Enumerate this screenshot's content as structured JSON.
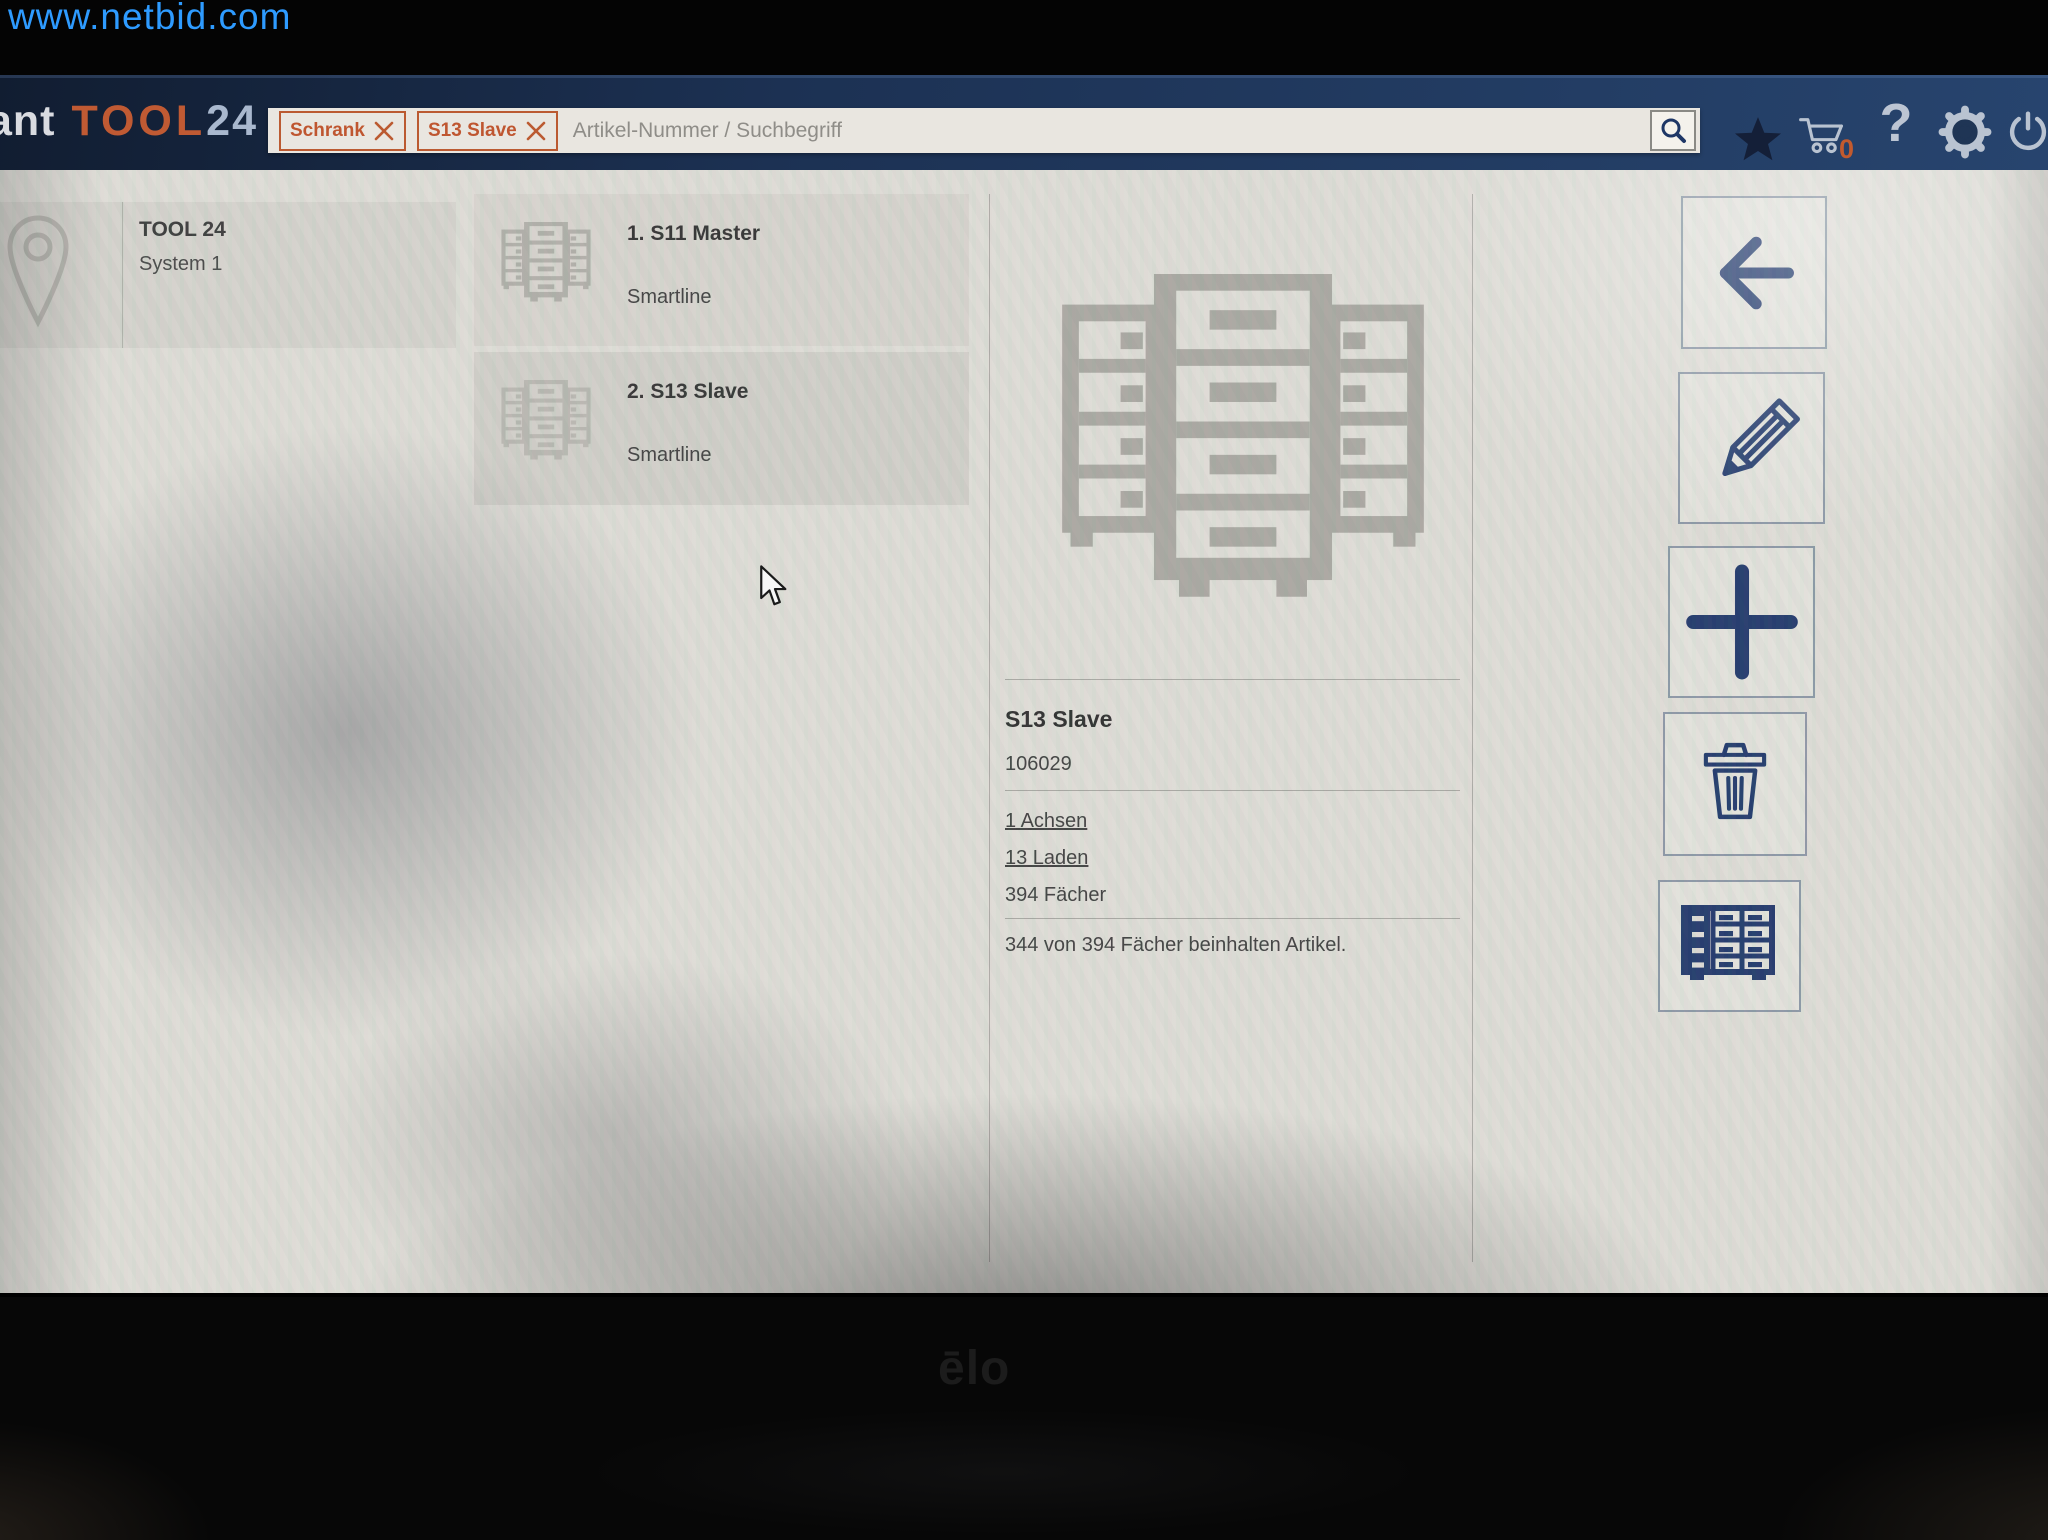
{
  "watermark": {
    "url_text": "www.netbid.com"
  },
  "header": {
    "brand": {
      "prefix": "ant",
      "tool": "TOOL",
      "suffix": "24"
    },
    "search": {
      "filter_chips": [
        {
          "label": "Schrank"
        },
        {
          "label": "S13 Slave"
        }
      ],
      "placeholder": "Artikel-Nummer / Suchbegriff"
    },
    "cart_badge": "0",
    "icons": [
      "search-icon",
      "star-icon",
      "cart-icon",
      "help-icon",
      "settings-gear-icon",
      "power-icon"
    ],
    "help_glyph": "?"
  },
  "location_panel": {
    "icon": "location-pin-icon",
    "title": "TOOL 24",
    "subtitle": "System 1"
  },
  "cabinet_list": {
    "items": [
      {
        "icon": "cabinet-icon",
        "title": "1. S11 Master",
        "subtitle": "Smartline",
        "selected": false
      },
      {
        "icon": "cabinet-icon",
        "title": "2. S13 Slave",
        "subtitle": "Smartline",
        "selected": true
      }
    ]
  },
  "detail": {
    "illustration": "cabinet-illustration",
    "title": "S13 Slave",
    "number": "106029",
    "axes_link": "1 Achsen",
    "drawers_link": "13 Laden",
    "compartments": "394 Fächer",
    "summary": "344 von 394 Fächer beinhalten Artikel."
  },
  "action_panel": {
    "buttons": [
      {
        "name": "back",
        "icon": "arrow-left-icon"
      },
      {
        "name": "edit",
        "icon": "pencil-icon"
      },
      {
        "name": "add",
        "icon": "plus-icon"
      },
      {
        "name": "delete",
        "icon": "trash-icon"
      },
      {
        "name": "cabinet-view",
        "icon": "drawer-cabinet-icon"
      }
    ]
  },
  "monitor": {
    "brand": "ēlo"
  },
  "colors": {
    "accent_orange": "#c0562f",
    "icon_navy": "#21386b",
    "header_navy": "#1d3254",
    "content_bg": "#dcdad4",
    "illustration_gray": "#a9a7a1",
    "watermark_blue": "#2e9bff"
  }
}
